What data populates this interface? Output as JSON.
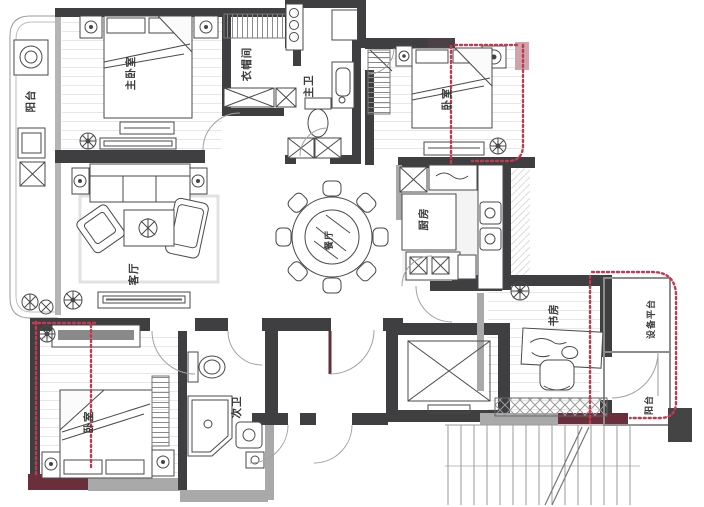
{
  "plan": {
    "rooms": [
      {
        "id": "master-bedroom",
        "label": "主卧室"
      },
      {
        "id": "cloakroom",
        "label": "衣帽间"
      },
      {
        "id": "master-bathroom",
        "label": "主卫"
      },
      {
        "id": "bedroom-top-right",
        "label": "卧室"
      },
      {
        "id": "living-room",
        "label": "客厅"
      },
      {
        "id": "dining-room",
        "label": "餐厅"
      },
      {
        "id": "kitchen",
        "label": "厨房"
      },
      {
        "id": "study",
        "label": "书房"
      },
      {
        "id": "equipment-platform",
        "label": "设备平台"
      },
      {
        "id": "balcony-right",
        "label": "阳台"
      },
      {
        "id": "balcony-left",
        "label": "阳台"
      },
      {
        "id": "bedroom-bottom-left",
        "label": "卧室"
      },
      {
        "id": "second-bathroom",
        "label": "次卫"
      }
    ],
    "colors": {
      "wall_dark": "#3f3e40",
      "wall_light": "#a9a9a9",
      "wall_maroon": "#6d2e3c",
      "marking_red": "#c23a50",
      "marking_fill": "#cfa4ad",
      "floor_line": "#e7e7e7"
    }
  }
}
